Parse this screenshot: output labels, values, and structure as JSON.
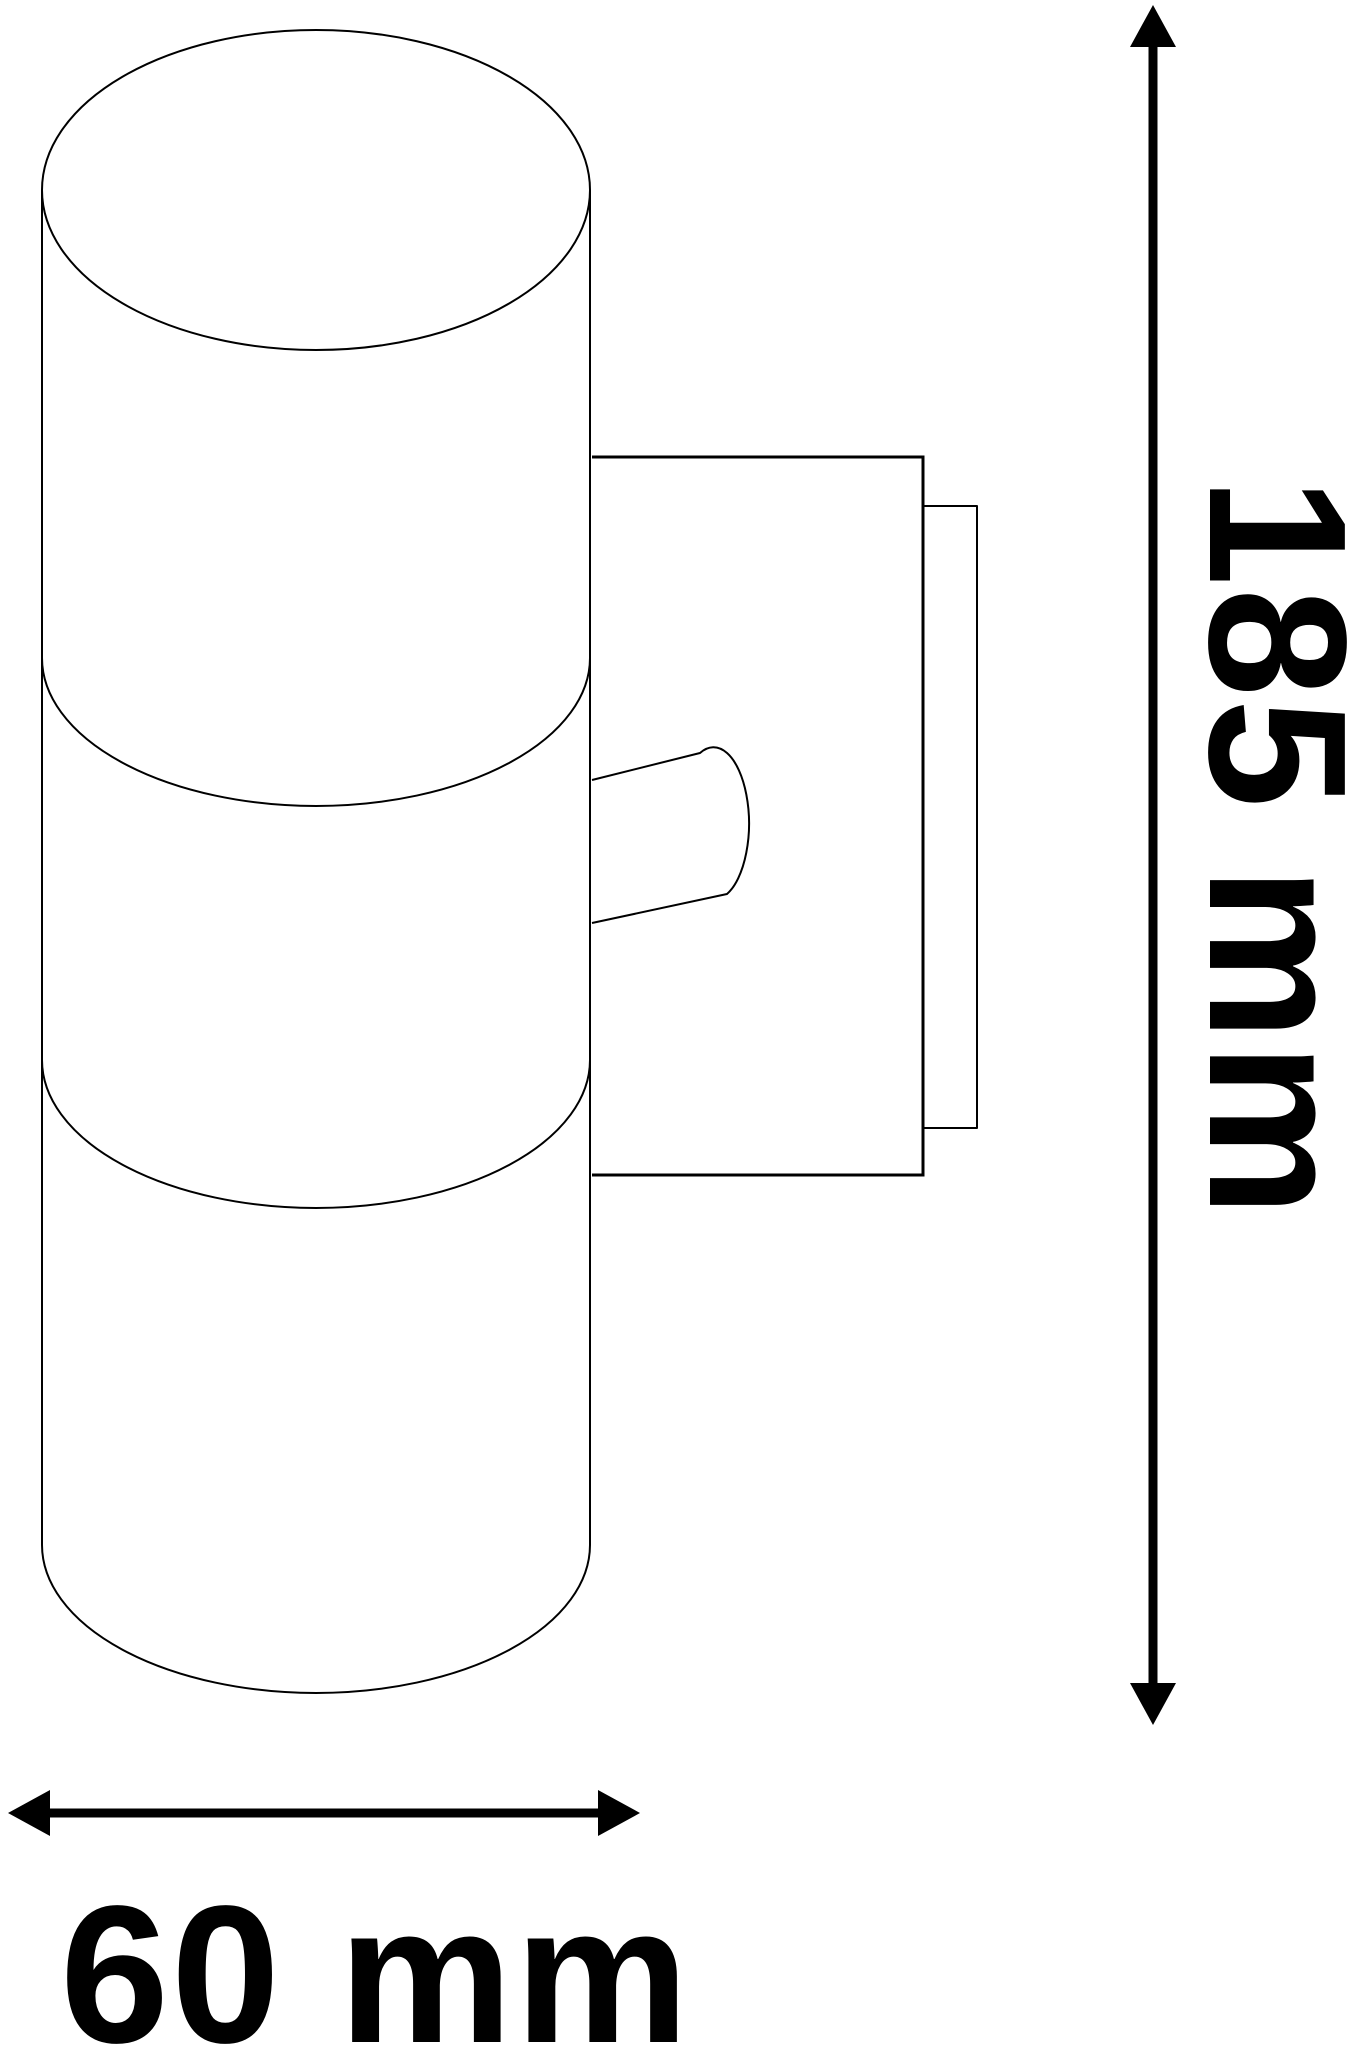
{
  "diagram": {
    "subject": "wall-light-fixture-side-view-dimension-drawing",
    "height_label": "185 mm",
    "width_label": "60 mm",
    "height_value": "185",
    "width_value": "60",
    "unit": "mm",
    "line_color": "#000000",
    "text_color": "#000000",
    "background_color": "#ffffff"
  }
}
